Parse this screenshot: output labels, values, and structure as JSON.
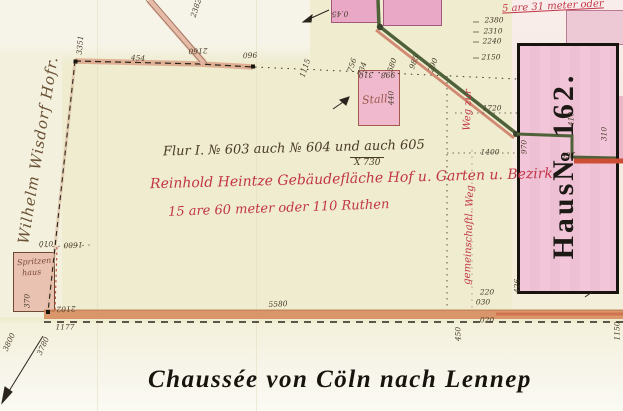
{
  "map": {
    "road_title": "Chaussée von Cöln nach Lennep",
    "annotation": {
      "line1": "Flur I. № 603 auch № 604 und auch 605",
      "fraction": "X 730",
      "line2": "Reinhold Heintze Gebäudefläche Hof u. Garten u. Bezirk",
      "line3": "15 are 60 meter oder 110 Ruthen"
    },
    "area_note": "5 are 31 meter oder",
    "house": {
      "label": "Haus№ 162."
    },
    "owner": "Wilhelm Wisdorf Hofr.",
    "stall": "Stall",
    "spritzenhaus_line1": "Spritzen",
    "spritzenhaus_line2": "haus",
    "road_label_upper": "Weg zur",
    "road_label_lower": "gemeinschaftl. Weg"
  },
  "colors": {
    "paper": "#efecd0",
    "building_pink": "#e8a8c6",
    "house_fill": "#f0c3d6",
    "green_road": "#4e6138",
    "orange_road": "#d78a5c",
    "red_ink": "#c23548",
    "brown_ink": "#5d4a33",
    "black_border": "#17130f"
  },
  "measurements": [
    {
      "t": "2382",
      "x": 196,
      "y": 8,
      "r": -72
    },
    {
      "t": "3351",
      "x": 80,
      "y": 45,
      "r": -85
    },
    {
      "t": "454",
      "x": 138,
      "y": 58,
      "r": 3
    },
    {
      "t": "2160",
      "x": 198,
      "y": 51,
      "r": 178
    },
    {
      "t": "960",
      "x": 250,
      "y": 55,
      "r": 178
    },
    {
      "t": "1115",
      "x": 305,
      "y": 68,
      "r": -72
    },
    {
      "t": "756",
      "x": 352,
      "y": 65,
      "r": -72
    },
    {
      "t": "734",
      "x": 362,
      "y": 69,
      "r": -72
    },
    {
      "t": "580",
      "x": 392,
      "y": 65,
      "r": -70
    },
    {
      "t": "985",
      "x": 414,
      "y": 62,
      "r": -70
    },
    {
      "t": "290",
      "x": 433,
      "y": 65,
      "r": -70
    },
    {
      "t": "0.45",
      "x": 340,
      "y": 14,
      "r": 178
    },
    {
      "t": "310",
      "x": 366,
      "y": 75,
      "r": 178
    },
    {
      "t": "998",
      "x": 388,
      "y": 75,
      "r": 178
    },
    {
      "t": "440",
      "x": 391,
      "y": 98,
      "r": -90
    },
    {
      "t": "2380",
      "x": 494,
      "y": 20,
      "r": 0
    },
    {
      "t": "2310",
      "x": 493,
      "y": 31,
      "r": 0
    },
    {
      "t": "2240",
      "x": 492,
      "y": 41,
      "r": 0
    },
    {
      "t": "2150",
      "x": 491,
      "y": 57,
      "r": 0
    },
    {
      "t": "1720",
      "x": 492,
      "y": 108,
      "r": 0
    },
    {
      "t": "1400",
      "x": 490,
      "y": 152,
      "r": 0
    },
    {
      "t": "970",
      "x": 524,
      "y": 147,
      "r": -90
    },
    {
      "t": "410",
      "x": 571,
      "y": 119,
      "r": -90
    },
    {
      "t": "310",
      "x": 604,
      "y": 134,
      "r": -90
    },
    {
      "t": "260",
      "x": 568,
      "y": 155,
      "r": 178
    },
    {
      "t": "220",
      "x": 487,
      "y": 292,
      "r": 0
    },
    {
      "t": "030",
      "x": 483,
      "y": 302,
      "r": 0
    },
    {
      "t": "020",
      "x": 487,
      "y": 320,
      "r": 0
    },
    {
      "t": "426",
      "x": 517,
      "y": 286,
      "r": -90
    },
    {
      "t": "450",
      "x": 458,
      "y": 334,
      "r": -90
    },
    {
      "t": "1150",
      "x": 617,
      "y": 331,
      "r": -90
    },
    {
      "t": "5580",
      "x": 278,
      "y": 304,
      "r": -3
    },
    {
      "t": "010",
      "x": 46,
      "y": 244,
      "r": 0
    },
    {
      "t": "1600",
      "x": 73,
      "y": 245,
      "r": 178
    },
    {
      "t": "2102",
      "x": 66,
      "y": 309,
      "r": 178
    },
    {
      "t": "1177",
      "x": 65,
      "y": 327,
      "r": 0
    },
    {
      "t": "370",
      "x": 27,
      "y": 301,
      "r": -90
    },
    {
      "t": "3800",
      "x": 9,
      "y": 342,
      "r": -65
    },
    {
      "t": "3780",
      "x": 43,
      "y": 346,
      "r": -65
    }
  ]
}
